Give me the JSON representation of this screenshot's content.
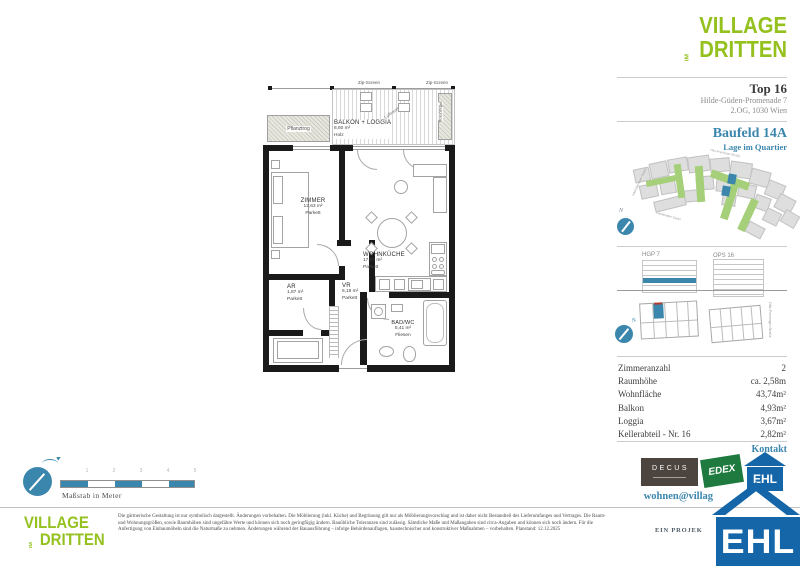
{
  "brand": {
    "line1": "VILLAGE",
    "im": "IM",
    "line2": "DRITTEN"
  },
  "header": {
    "top": "Top 16",
    "address": "Hilde-Güden-Promenade 7",
    "floor_city": "2.OG, 1030 Wien"
  },
  "quartier": {
    "title": "Baufeld 14A",
    "subtitle": "Lage im Quartier",
    "north": "N",
    "streets": {
      "top": "Otto-Preminger-Straße",
      "left": "Adolf-Blamauer-Gasse",
      "bottom": "Landstraßer Gürtel"
    }
  },
  "buildings": {
    "left_label": "HGP 7",
    "right_label": "OPS 16",
    "street_side": "Otto-Preminger-Straße",
    "north": "N"
  },
  "details": {
    "rows": [
      {
        "label": "Zimmeranzahl",
        "value": "2"
      },
      {
        "label": "Raumhöhe",
        "value": "ca. 2,58m"
      },
      {
        "label": "Wohnfläche",
        "value": "43,74m²"
      },
      {
        "label": "Balkon",
        "value": "4,93m²"
      },
      {
        "label": "Loggia",
        "value": "3,67m²"
      },
      {
        "label": "Kellerabteil - Nr. 16",
        "value": "2,82m²"
      }
    ]
  },
  "contact": {
    "heading": "Kontakt",
    "email": "wohnen@villag",
    "project": "EIN PROJEK"
  },
  "partners": {
    "decus": "DECUS",
    "edex": "EDEX",
    "ehl": "EHL",
    "ehl_big": "EHL"
  },
  "plan": {
    "zip1": "Zip-Screen",
    "zip2": "Zip-Screen",
    "planter_left": "Pflanztrog",
    "planter_right": "Pflanztrog",
    "airspace": "Luftraum",
    "balcony": {
      "name": "BALKON + LOGGIA",
      "area": "8,60 m²",
      "surface": "Holz"
    },
    "zimmer": {
      "name": "ZIMMER",
      "area": "12,63 m²",
      "surface": "Parkett"
    },
    "wohnkueche": {
      "name": "WOHNKÜCHE",
      "area": "17,47 m²",
      "surface": "Parkett"
    },
    "ar": {
      "name": "AR",
      "area": "1,87 m²",
      "surface": "Parkett"
    },
    "vr": {
      "name": "VR",
      "area": "6,18 m²",
      "surface": "Parkett"
    },
    "bad": {
      "name": "BAD/WC",
      "area": "5,41 m²",
      "surface": "Fliesen"
    }
  },
  "scalebar": {
    "numbers": [
      "1",
      "2",
      "3",
      "4",
      "5"
    ],
    "caption": "Maßstab in Meter"
  },
  "footer": {
    "disclaimer": "Die gärtnerische Gestaltung ist nur symbolisch dargestellt. Änderungen vorbehalten. Die Möblierung (inkl. Küche) und Begrünung gilt nur als Möblierungsvorschlag und ist daher nicht Bestandteil des Lieferumfanges und Vertrages. Die Raum- und Wohnungsgrößen, sowie Raumhöhen sind ungefähre Werte und können sich noch geringfügig ändern. Bauübliche Toleranzen sind zulässig. Sämtliche Maße und Maßangaben sind circa-Angaben und können sich noch ändern. Für die Anfertigung von Einbaumöbeln sind die Naturmaße zu nehmen. Änderungen während der Bauausführung – infolge Behördenauflagen, haustechnischer und konstruktiver Maßnahmen – vorbehalten. Planstand: 12.12.2025"
  },
  "colors": {
    "green": "#95c11f",
    "teal": "#3b86ad",
    "ehl_blue": "#1565a9",
    "edex_green": "#1e7a3e",
    "decus_brown": "#4c443e"
  }
}
